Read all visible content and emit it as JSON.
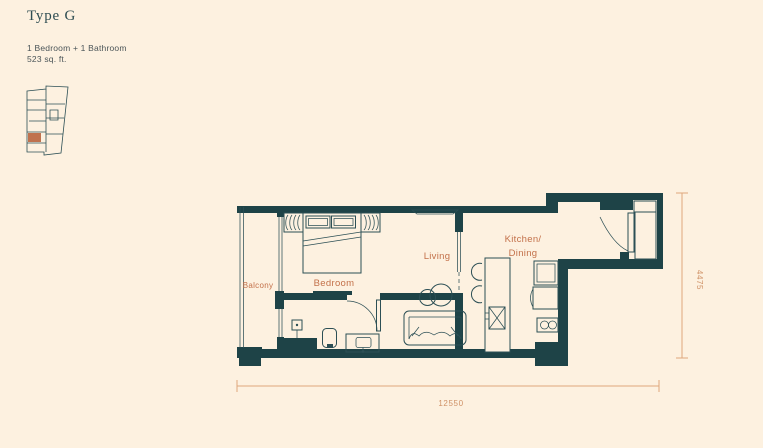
{
  "plan": {
    "title": "Type G",
    "config": "1 Bedroom + 1 Bathroom",
    "area": "523 sq. ft.",
    "rooms": {
      "balcony": "Balcony",
      "bedroom": "Bedroom",
      "living": "Living",
      "kitchen_line1": "Kitchen/",
      "kitchen_line2": "Dining"
    },
    "dimensions": {
      "width": "12550",
      "height": "4475"
    },
    "colors": {
      "background": "#fdf1e0",
      "wall": "#1e4347",
      "line": "#2c4f55",
      "label": "#c3714a",
      "dimension": "#dfa77c",
      "dimension_text": "#cf9166",
      "title": "#2e4d52",
      "subtitle": "#4b5558",
      "unit_highlight": "#c0724e"
    }
  }
}
